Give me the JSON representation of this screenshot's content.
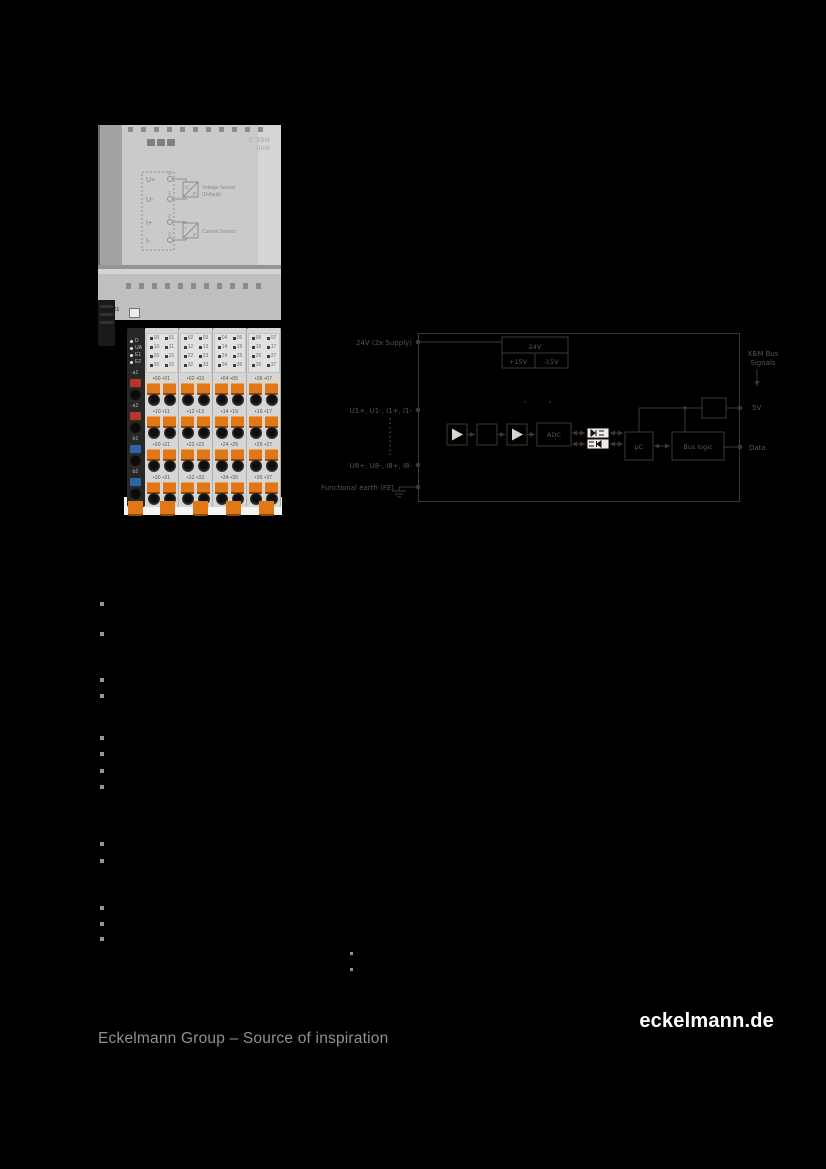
{
  "product_photo": {
    "model_line1": "E°XBM",
    "model_line2": "AI08",
    "connector_label": "X1",
    "schematic": {
      "terminals": [
        "U+",
        "U-",
        "I+",
        "I-"
      ],
      "pins": [
        "6",
        "1",
        "2",
        "3"
      ],
      "sensor1_letters": [
        "U",
        "P"
      ],
      "sensor2_letters": [
        "I",
        "P"
      ],
      "sensor1_label1": "Voltage Sensor",
      "sensor1_label2": "(Default)",
      "sensor2_label": "Current Sensor"
    },
    "status_leds": [
      "D",
      "UA",
      "E1",
      "E2"
    ],
    "power_rows": [
      {
        "label": "a1",
        "color": "#b5362a"
      },
      {
        "label": "a2",
        "color": "#b5362a"
      },
      {
        "label": "b1",
        "color": "#2d65a3"
      },
      {
        "label": "b2",
        "color": "#2d65a3"
      }
    ],
    "led_rows": [
      [
        "00",
        "01",
        "02",
        "03",
        "04",
        "05",
        "06",
        "07"
      ],
      [
        "10",
        "11",
        "12",
        "13",
        "14",
        "15",
        "16",
        "17"
      ],
      [
        "20",
        "21",
        "22",
        "23",
        "24",
        "25",
        "26",
        "27"
      ],
      [
        "30",
        "31",
        "32",
        "33",
        "34",
        "35",
        "36",
        "37"
      ]
    ],
    "clamp_color": "#e07818"
  },
  "diagram": {
    "labels": {
      "supply": "24V (2x Supply)",
      "ch1": "U1+, U1-, I1+, I1-",
      "ch8": "U8+, U8-, I8+, I8-",
      "fe": "Functional earth (FE)",
      "bus_line1": "XBM Bus",
      "bus_line2": "Signals",
      "v5": "5V",
      "data": "Data"
    },
    "power_block": {
      "top": "24V",
      "left": "+15V",
      "right": "-15V"
    },
    "blocks": {
      "adc": "ADC",
      "uc": "µC",
      "bus": "Bus logic"
    },
    "line_color": "#3e3934",
    "text_color": "#5a544c"
  },
  "bullets": {
    "color": "#969696",
    "main": [
      {
        "x": 100,
        "y": 602
      },
      {
        "x": 100,
        "y": 632
      },
      {
        "x": 100,
        "y": 678
      },
      {
        "x": 100,
        "y": 694
      },
      {
        "x": 100,
        "y": 736
      },
      {
        "x": 100,
        "y": 752
      },
      {
        "x": 100,
        "y": 769
      },
      {
        "x": 100,
        "y": 785
      },
      {
        "x": 100,
        "y": 842
      },
      {
        "x": 100,
        "y": 859
      },
      {
        "x": 100,
        "y": 906
      },
      {
        "x": 100,
        "y": 922
      },
      {
        "x": 100,
        "y": 937
      }
    ],
    "sub": [
      {
        "x": 350,
        "y": 952
      },
      {
        "x": 350,
        "y": 968
      }
    ]
  },
  "footer": {
    "left": "Eckelmann Group – Source of inspiration",
    "right": "eckelmann.de"
  }
}
